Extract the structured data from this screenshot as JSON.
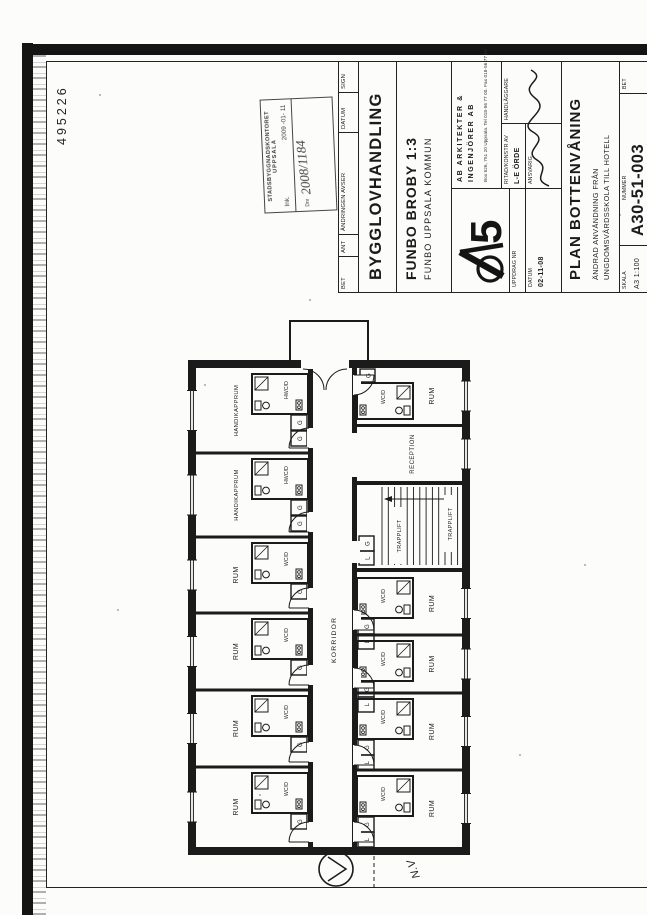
{
  "scan_number": "495226",
  "stamp": {
    "office": "STADSBYGGNADSKONTORET",
    "city": "UPPSALA",
    "ink_label": "Ink.",
    "ink_date": "2009 -01- 11",
    "dnr_label": "Dnr",
    "dnr_value": "2008/1184"
  },
  "revision": {
    "bet": "BET",
    "ant": "ANT",
    "avser": "ÄNDRINGEN AVSER",
    "datum": "DATUM",
    "sign": "SIGN"
  },
  "doc": {
    "handling": "BYGGLOVHANDLING",
    "property": "FUNBO BROBY 1:3",
    "kommun": "FUNBO  UPPSALA KOMMUN"
  },
  "firm": {
    "logo_numeral": "5",
    "name1": "AB ARKITEKTER &",
    "name2": "INGENJÖRER AB",
    "address": "Box 526, 751 20 Uppsala. Tel 018-56 77 00. Fax 018-56 77 10"
  },
  "fields": {
    "uppdrag_label": "UPPDRAG NR",
    "datum_label": "DATUM",
    "datum_value": "02-11-08",
    "ritad_label": "RITAD/KONSTR AV",
    "ritad_value": "L-E ÖRDE",
    "ansvarig_label": "ANSVARIG",
    "handlaggare_label": "HANDLÄGGARE"
  },
  "title": {
    "name": "PLAN BOTTENVÅNING",
    "sub1": "ÄNDRAD ANVÄNDNING FRÅN",
    "sub2": "UNGDOMSVÅRDSSKOLA TILL HOTELL",
    "skala_label": "SKALA",
    "skala_value": "A3  1:100",
    "nummer_label": "NUMMER",
    "nummer_value": "A30-51-003",
    "bet_label": "BET"
  },
  "plan": {
    "corridor": "KORRIDOR",
    "reception": "RECEPTION",
    "stair": "TRAPPLIFT",
    "note": "N.V",
    "closet_g": "G",
    "closet_l": "L",
    "rooms_top": [
      {
        "label": "RUM",
        "bath": "WC/D"
      },
      {
        "label": "RUM",
        "bath": "WC/D"
      },
      {
        "label": "RUM",
        "bath": "WC/D"
      },
      {
        "label": "RUM",
        "bath": "WC/D"
      },
      {
        "label": "HANDIKAPPRUM",
        "bath": "HWC/D"
      },
      {
        "label": "HANDIKAPPRUM",
        "bath": "HWC/D"
      }
    ],
    "rooms_bottom": [
      {
        "label": "RUM",
        "bath": "WC/D"
      },
      {
        "label": "RUM",
        "bath": "WC/D"
      },
      {
        "label": "RUM",
        "bath": "WC/D"
      },
      {
        "label": "RUM",
        "bath": "WC/D"
      },
      {
        "label": "RUM",
        "bath": "WC/D"
      }
    ]
  }
}
